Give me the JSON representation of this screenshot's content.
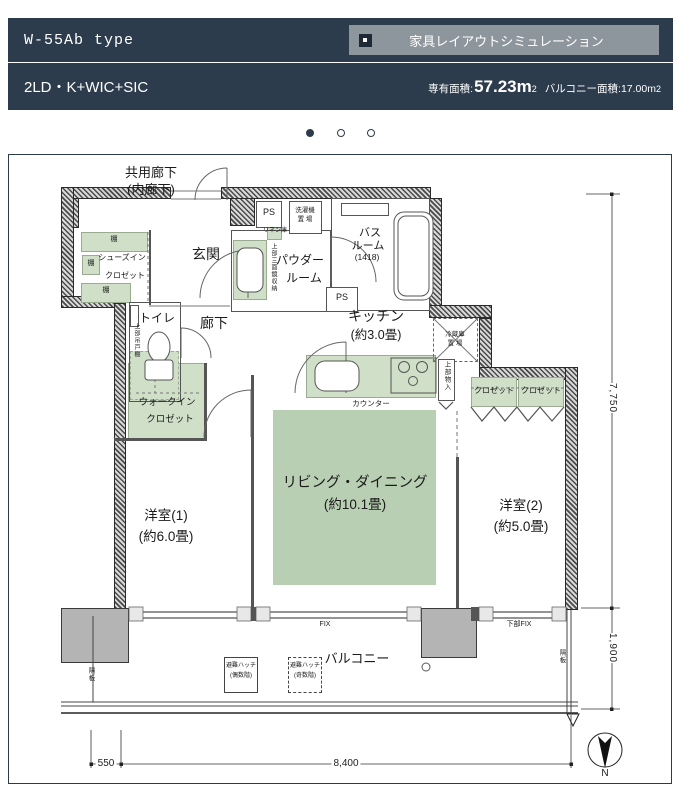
{
  "header": {
    "plan_type": "W-55Ab type",
    "sim_button": "家具レイアウトシミュレーション",
    "layout": "2LD・K+WIC+SIC",
    "area_label": "専有面積:",
    "area_value": "57.23m",
    "area_sup": "2",
    "balcony_area_label": "バルコニー面積:17.00m",
    "balcony_area_sup": "2"
  },
  "plan": {
    "labels": {
      "common1": "共用廊下",
      "common2": "(内廊下)",
      "genkan": "玄関",
      "sic1": "シューズイン",
      "sic2": "クロゼット",
      "shelf": "棚",
      "ps": "PS",
      "laundry1": "洗濯機",
      "laundry2": "置 場",
      "bath1": "バス",
      "bath2": "ルーム",
      "bath3": "(1418)",
      "linen": "リネン庫",
      "mirror": "上部三面鏡収納",
      "powder1": "パウダー",
      "powder2": "ルーム",
      "toilet": "トイレ",
      "toilet_shelf": "上部吊戸棚",
      "hallway": "廊下",
      "kitchen1": "キッチン",
      "kitchen2": "(約3.0畳)",
      "fridge1": "冷蔵庫",
      "fridge2": "置 場",
      "counter": "カウンター",
      "upper_storage": "上部物入",
      "closet": "クロゼット",
      "wic1": "ウォークイン",
      "wic2": "クロゼット",
      "living1": "リビング・ダイニング",
      "living2": "(約10.1畳)",
      "bed1a": "洋室(1)",
      "bed1b": "(約6.0畳)",
      "bed2a": "洋室(2)",
      "bed2b": "(約5.0畳)",
      "fix": "FIX",
      "lower_fix": "下部FIX",
      "balcony": "バルコニー",
      "hatch": "避難ハッチ",
      "hatch_even": "(偶数階)",
      "hatch_odd": "(奇数階)",
      "partition": "隔板"
    },
    "dimensions": {
      "d7750": "7,750",
      "d1900": "1,900",
      "d550": "550",
      "d8400": "8,400"
    },
    "compass_n": "N"
  }
}
